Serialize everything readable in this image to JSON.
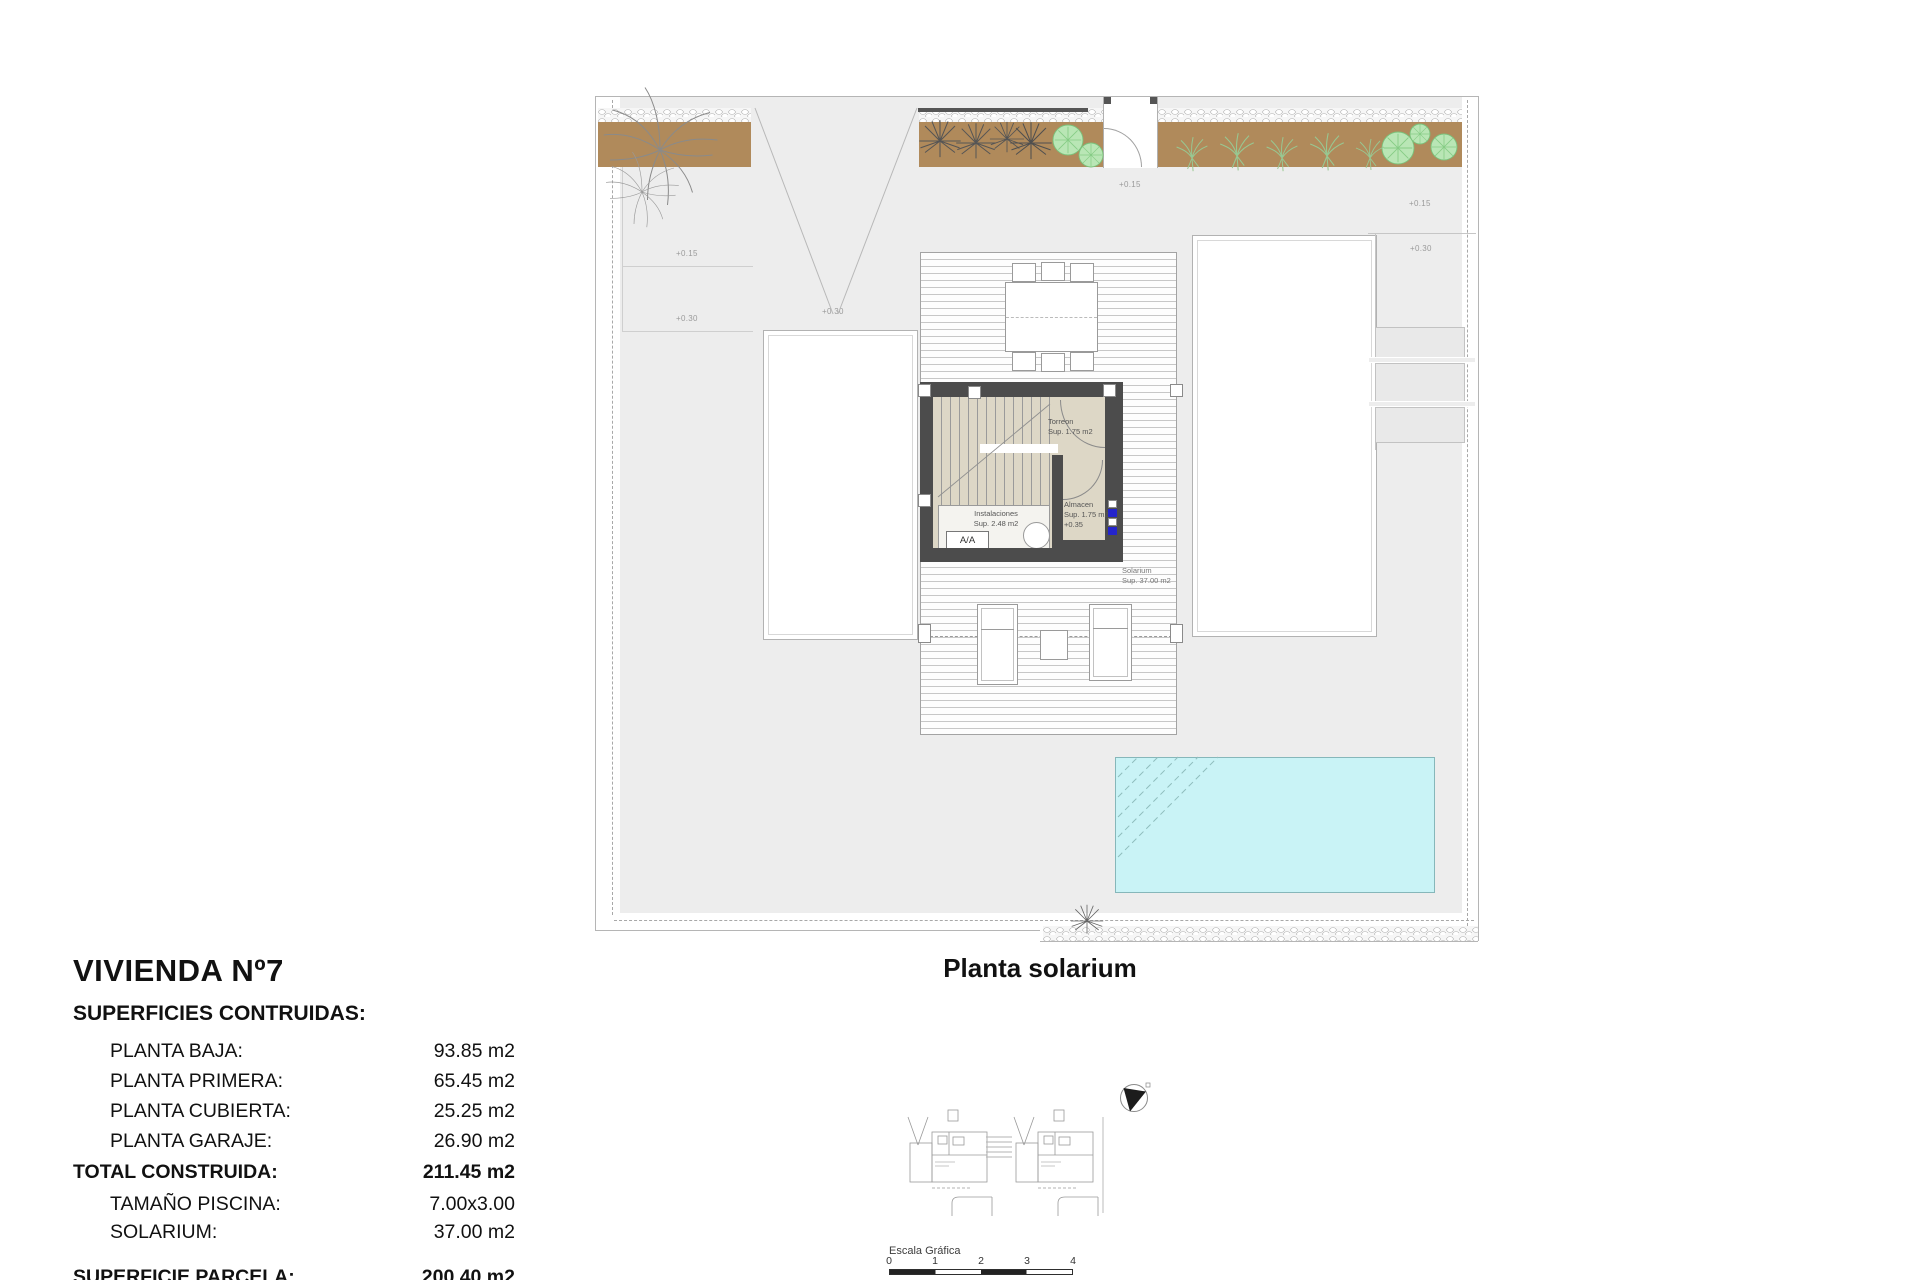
{
  "info_panel": {
    "title": "VIVIENDA Nº7",
    "subtitle": "SUPERFICIES CONTRUIDAS:",
    "rows": [
      {
        "label": "PLANTA BAJA:",
        "value": "93.85 m2"
      },
      {
        "label": "PLANTA PRIMERA:",
        "value": "65.45 m2"
      },
      {
        "label": "PLANTA CUBIERTA:",
        "value": "25.25 m2"
      },
      {
        "label": "PLANTA GARAJE:",
        "value": "26.90 m2"
      }
    ],
    "total_row": {
      "label": "TOTAL CONSTRUIDA:",
      "value": "211.45 m2"
    },
    "extra_rows": [
      {
        "label": "TAMAÑO PISCINA:",
        "value": "7.00x3.00"
      },
      {
        "label": "SOLARIUM:",
        "value": "37.00 m2"
      }
    ],
    "parcel_row": {
      "label": "SUPERFICIE PARCELA:",
      "value": "200.40 m2"
    }
  },
  "plan": {
    "caption": "Planta solarium",
    "rooms": {
      "torreon_name": "Torreon",
      "torreon_area": "Sup. 1.75 m2",
      "almacen_name": "Almacen",
      "almacen_area": "Sup. 1.75 m2",
      "almacen_level": "+0.35",
      "instalaciones_name": "Instalaciones",
      "instalaciones_area": "Sup. 2.48 m2",
      "ac_label": "A/A",
      "solarium_name": "Solarium",
      "solarium_area": "Sup. 37.00 m2"
    },
    "elevation_marks": [
      {
        "text": "+0.15"
      },
      {
        "text": "+0.30"
      },
      {
        "text": "+0.30"
      },
      {
        "text": "+0.15"
      },
      {
        "text": "+0.15"
      },
      {
        "text": "+0.30"
      }
    ]
  },
  "key_plan": {
    "scale_title": "Escala Gráfica",
    "scale_ticks": [
      "0",
      "1",
      "2",
      "3",
      "4"
    ]
  },
  "colors": {
    "parcel_gray": "#ededed",
    "planting_brown": "#b08a5b",
    "pool_cyan": "#c9f3f6",
    "wall_dark": "#4c4c4c",
    "floor_beige": "#ddd7c6",
    "key_highlight_green": "#d9efcf",
    "marker_blue": "#2424cc",
    "bush_green": "#b9e6b5"
  }
}
